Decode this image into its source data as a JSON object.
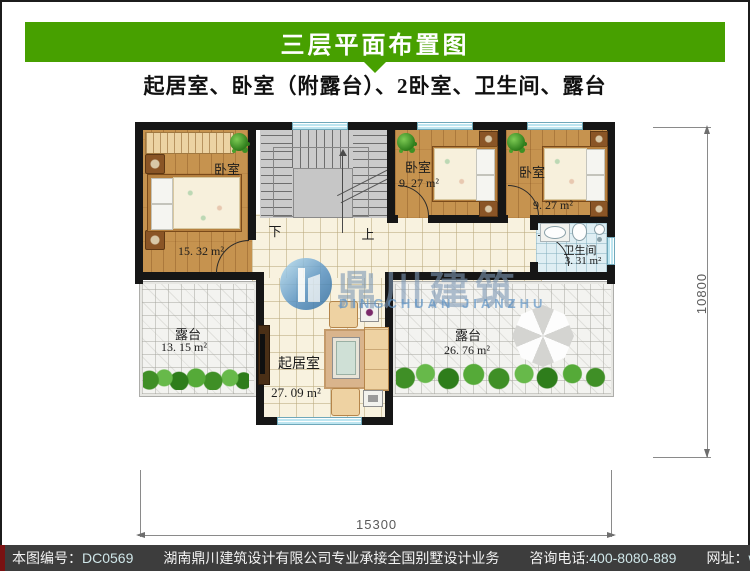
{
  "header": {
    "title": "三层平面布置图",
    "subtitle": "起居室、卧室（附露台）、2卧室、卫生间、露台",
    "bar_color": "#47a000"
  },
  "plan": {
    "rooms": [
      {
        "label": "卧室",
        "area": "15. 32 m²"
      },
      {
        "label": "卧室",
        "area": "9. 27 m²"
      },
      {
        "label": "卧室",
        "area": "9. 27 m²"
      },
      {
        "label": "卫生间",
        "area": "3. 31 m²"
      },
      {
        "label": "起居室",
        "area": "27. 09 m²"
      },
      {
        "label": "露台",
        "area": "13. 15 m²"
      },
      {
        "label": "露台",
        "area": "26. 76 m²"
      }
    ],
    "stairs": {
      "down_label": "下",
      "up_label": "上"
    },
    "dimensions": {
      "width_mm": "15300",
      "height_mm": "10800"
    },
    "watermark": {
      "cn": "鼎川建筑",
      "en": "DINGCHUAN JIANZHU"
    }
  },
  "footer": {
    "code_label": "本图编号：",
    "code": "DC0569",
    "company": "湖南鼎川建筑设计有限公司专业承接全国别墅设计业务",
    "phone_label": "咨询电话:",
    "phone": "400-8080-889",
    "site_label": "网址：",
    "site": "www.bstzcs.com"
  }
}
